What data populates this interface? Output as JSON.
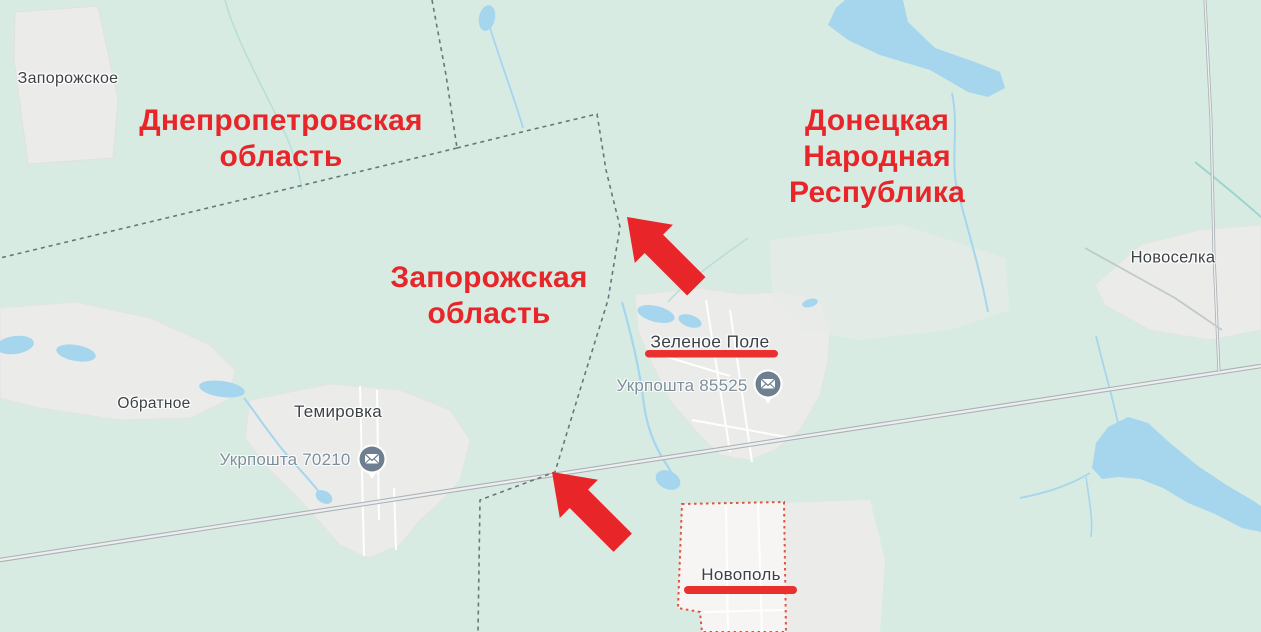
{
  "annotations": {
    "color": "#e8262a",
    "underline_color": "#e8302e",
    "regions": [
      {
        "id": "dnipropetrovsk-oblast",
        "label": "Днепропетровская\nобласть"
      },
      {
        "id": "donetsk-peoples-republic",
        "label": "Донецкая\nНародная\nРеспублика"
      },
      {
        "id": "zaporizhzhia-oblast",
        "label": "Запорожская\nобласть"
      }
    ],
    "arrows": [
      {
        "id": "arrow-1",
        "direction": "up-left"
      },
      {
        "id": "arrow-2",
        "direction": "up-left"
      }
    ],
    "underlined_places": [
      "Зеленое Поле",
      "Новополь"
    ]
  },
  "places": {
    "towns": [
      {
        "id": "zaporozhskoe",
        "label": "Запорожское"
      },
      {
        "id": "obratnoe",
        "label": "Обратное"
      },
      {
        "id": "temirovka",
        "label": "Темировка"
      },
      {
        "id": "novoselka",
        "label": "Новоселка"
      },
      {
        "id": "zelenoe-pole",
        "label": "Зеленое Поле"
      },
      {
        "id": "novopol",
        "label": "Новополь"
      }
    ],
    "pois": [
      {
        "id": "ukrposhta-85525",
        "label": "Укрпошта 85525",
        "icon": "envelope-pin-icon"
      },
      {
        "id": "ukrposhta-70210",
        "label": "Укрпошта 70210",
        "icon": "envelope-pin-icon"
      }
    ]
  },
  "map_colors": {
    "background": "#d7ebe2",
    "water": "#a5d6ee",
    "settlement_fill": "#ebecea",
    "selected_area_fill": "#f6f5f3",
    "selected_area_border": "#df5442",
    "road": "#b0b4b6",
    "admin_border": "#5c6a70",
    "town_label": "#3d4247",
    "poi_label": "#7d8f9b",
    "poi_pin": "#6e8090"
  }
}
